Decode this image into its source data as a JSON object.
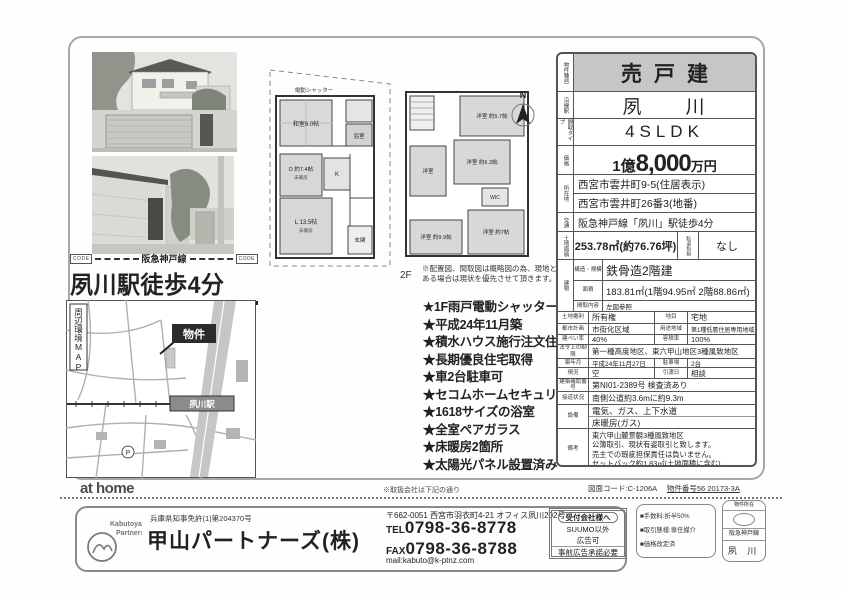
{
  "table": {
    "type_label": "物件種目",
    "type_value": "売戸建",
    "line_label": "沿線駅",
    "line_value": "夙　　川",
    "plan_label": "間取タイプ",
    "plan_value": "4SLDK",
    "price_label": "価格",
    "price_oku": "1億",
    "price_man": "8,000",
    "price_unit": "万円",
    "address_label": "所在地",
    "address1": "西宮市雲井町9-5(住居表示)",
    "address2": "西宮市雲井町26番3(地番)",
    "access_label": "交通",
    "access_value": "阪急神戸線「夙川」駅徒歩4分",
    "land_label": "土地面積",
    "land_value": "253.78㎡(約76.76坪)",
    "shido_label": "私道負担",
    "shido_value": "なし",
    "building_label": "建物",
    "structure_label": "構造・規模",
    "structure_value": "鉄骨造2階建",
    "barea_label": "面積",
    "barea_value": "183.81㎡(1階94.95㎡ 2階88.86㎡)",
    "madori_label": "間取内容",
    "madori_value": "左図参照",
    "right_label": "土地権利",
    "right_value": "所有権",
    "mokuteki_label": "地目",
    "mokuteki_value": "宅地",
    "plan2_label": "都市計画",
    "plan2_value": "市街化区域",
    "youto_label": "用途地域",
    "youto_value": "第1種低層住居専用地域",
    "kenpei_label": "建ぺい率",
    "kenpei_value": "40%",
    "yoseki_label": "容積率",
    "yoseki_value": "100%",
    "law_label": "法令上の制限",
    "law_value": "第一種高度地区、東六甲山地区3種風致地区",
    "built_label": "築年月",
    "built_value": "平成24年11月27日",
    "parking_label": "駐車場",
    "parking_value": "2台",
    "now_label": "現況",
    "now_value": "空",
    "hikiwatashi_label": "引渡日",
    "hikiwatashi_value": "相談",
    "kakunin_label": "建築確認番号",
    "kakunin_value": "第NI01-2389号 検査済あり",
    "road_label": "接道状況",
    "road_value": "南側公道約3.6mに約9.3m",
    "setsubi_label": "設備",
    "setsubi1": "電気、ガス、上下水道",
    "setsubi2": "床暖房(ガス)",
    "biko_label": "備考",
    "biko1": "東六甲山麓景観3種風致地区",
    "biko2": "公簿取引、現状有姿取引と致します。",
    "biko3": "売主での瑕疵担保責任は負いません。",
    "biko4": "セットバック約1.83㎡(土地面積に含む)"
  },
  "banner": {
    "code_left": "CODE",
    "code_right": "CODE",
    "rail_line": "阪急神戸線",
    "headline": "夙川駅徒歩4分"
  },
  "map": {
    "title": "周辺環境MAP",
    "property": "物件",
    "station": "夙川駅",
    "parking": "P"
  },
  "floorplan": {
    "shutter": "電動シャッター",
    "washitsu": "和室6.0帖",
    "bath": "浴室",
    "d": "D 約7.4帖",
    "d_sub": "床暖房",
    "k": "K",
    "l": "L 13.5帖",
    "l_sub": "床暖房",
    "genkan": "玄関",
    "r1": "洋室 約5.7帖",
    "r2": "洋室 約6.3帖",
    "r3": "洋室",
    "wic": "WIC",
    "r4": "洋室 約9.9帖",
    "r5": "洋室 約7帖",
    "caption_2f": "2F",
    "north": "N"
  },
  "disclaimer": "※配置図、間取図は概略図の為、現地と相違ある場合は現状を優先させて頂きます。",
  "features": [
    "★1F雨戸電動シャッター",
    "★平成24年11月築",
    "★積水ハウス施行注文住宅",
    "★長期優良住宅取得",
    "★車2台駐車可",
    "★セコムホームセキュリティ",
    "★1618サイズの浴室",
    "★全室ペアガラス",
    "★床暖房2箇所",
    "★太陽光パネル設置済み"
  ],
  "footer_bar": {
    "brand": "at home",
    "note": "※取扱会社は下記の通り",
    "sheet_code": "図面コード:C-1206A",
    "item_no": "物件番号56 20173-3A"
  },
  "company": {
    "logo1": "Kabutoyama",
    "logo2": "Partners",
    "license": "兵庫県知事免許(1)第204370号",
    "name": "甲山パートナーズ(株)",
    "address": "〒662-0051 西宮市羽衣町4-21 オフィス夙川202号",
    "tel_label": "TEL",
    "tel": "0798-36-8778",
    "fax_label": "FAX",
    "fax": "0798-36-8788",
    "mail": "mail:kabuto@k-ptnz.com"
  },
  "broker_box": {
    "title": "受付会社様へ",
    "line1": "SUUMO以外",
    "line2": "広告可",
    "line3": "事前広告承諾必要"
  },
  "broker_notes": [
    "■手数料:折半50%",
    "■取引態様:専任媒介",
    "■価格改定済"
  ],
  "side_tab": {
    "header": "物件所在",
    "line": "阪急神戸線",
    "station": "夙 川"
  }
}
